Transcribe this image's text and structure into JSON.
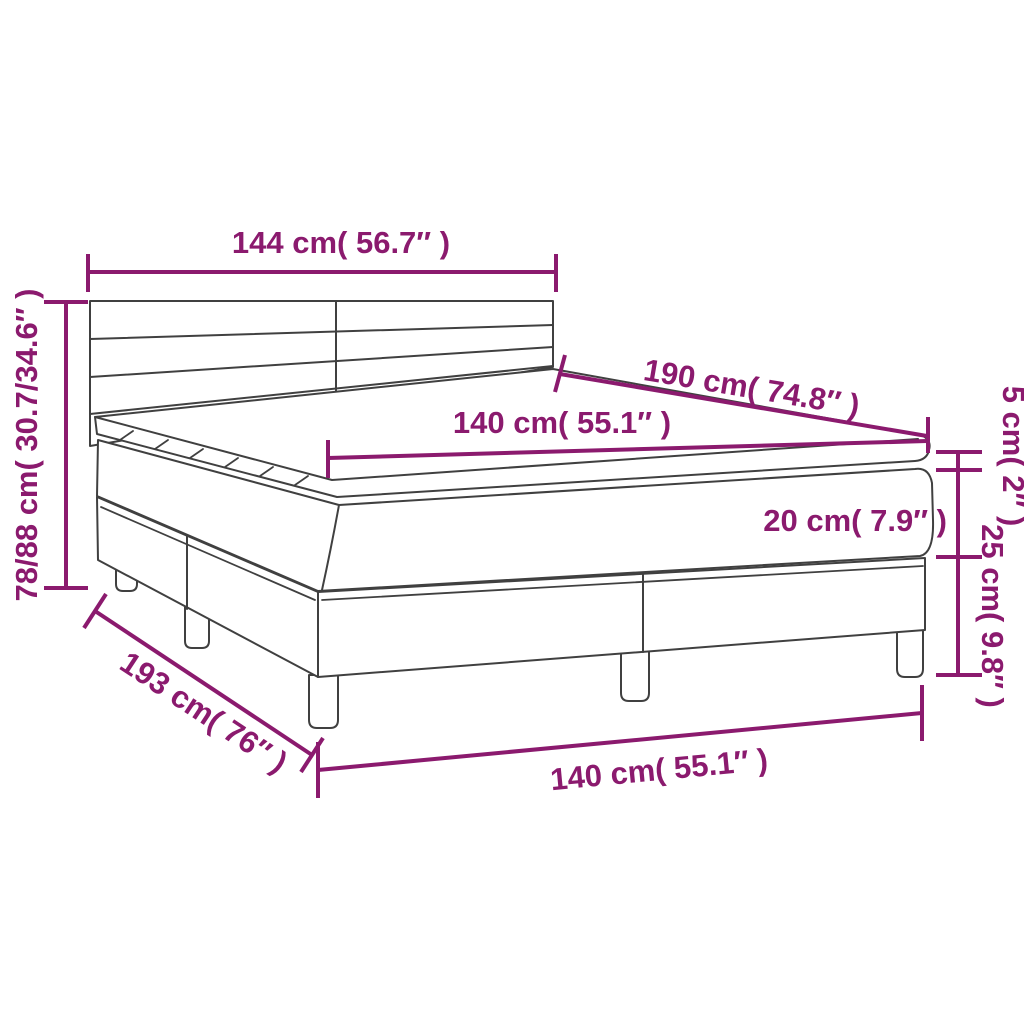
{
  "colors": {
    "dimension_accent": "#8b1a6e",
    "product_outline": "#404040",
    "background": "#ffffff"
  },
  "dimensions": {
    "headboard_width": {
      "label": "144 cm( 56.7″ )"
    },
    "overall_height": {
      "label": "78/88 cm( 30.7/34.6″ )"
    },
    "length_top": {
      "label": "190 cm( 74.8″ )"
    },
    "width_top": {
      "label": "140 cm( 55.1″ )"
    },
    "topper_thickness": {
      "label": "5 cm( 2″ )"
    },
    "mattress_thickness": {
      "label": "20 cm( 7.9″ )"
    },
    "base_height": {
      "label": "25 cm( 9.8″ )"
    },
    "length_bottom": {
      "label": "193 cm( 76″ )"
    },
    "width_bottom": {
      "label": "140 cm( 55.1″ )"
    }
  }
}
